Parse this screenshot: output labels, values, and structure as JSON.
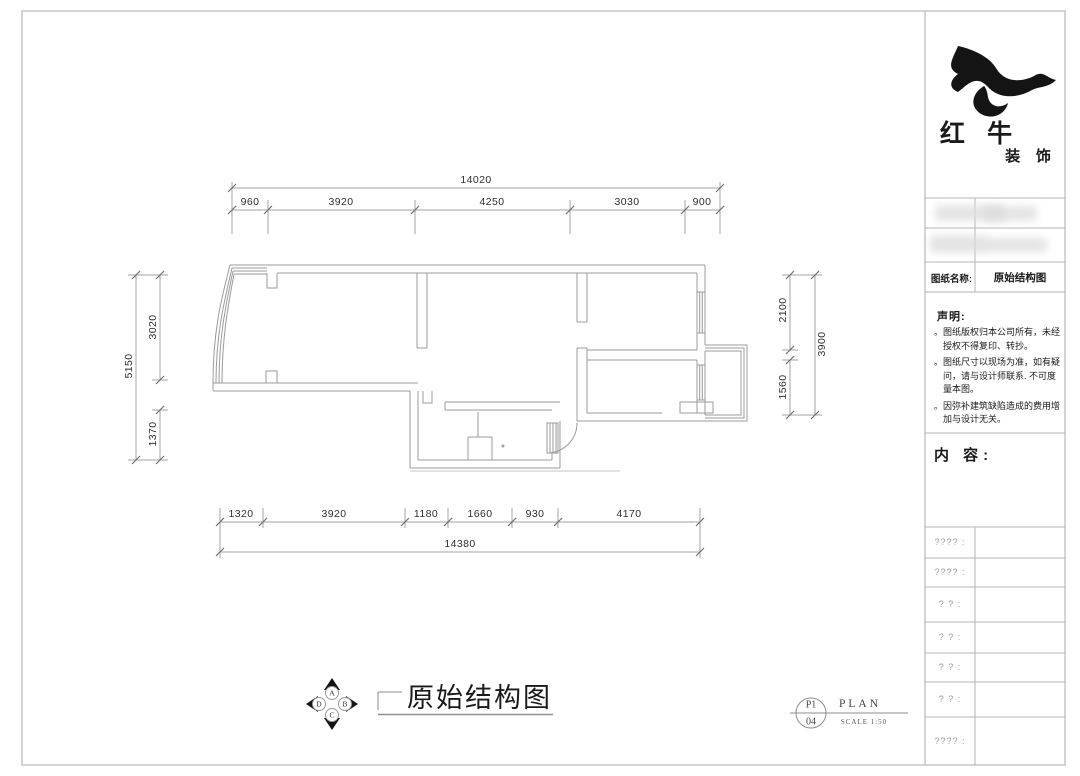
{
  "titleblock": {
    "brand_name": "红 牛",
    "brand_suffix": "装 饰",
    "drawing_name_label": "图纸名称:",
    "drawing_name_value": "原始结构图",
    "statement_title": "声明:",
    "bullet_char": "。",
    "statement_items": [
      "图纸版权归本公司所有，未经授权不得复印、转抄。",
      "图纸尺寸以现场为准，如有疑问，请与设计师联系. 不可度量本图。",
      "因弥补建筑缺陷造成的费用增加与设计无关。"
    ],
    "content_label": "内 容:",
    "info_rows": [
      "???? :",
      "???? :",
      "? ? :",
      "? ? :",
      "? ? :",
      "? ? :",
      "???? :"
    ]
  },
  "plan": {
    "dims_top": {
      "total": "14020",
      "segments": [
        "960",
        "3920",
        "4250",
        "3030",
        "900"
      ]
    },
    "dims_bottom": {
      "total": "14380",
      "segments": [
        "1320",
        "3920",
        "1180",
        "1660",
        "930",
        "4170"
      ]
    },
    "dims_left": {
      "total": "5150",
      "segments": [
        "3020",
        "1370"
      ]
    },
    "dims_right": {
      "total": "3900",
      "segments": [
        "2100",
        "1560"
      ]
    }
  },
  "footer": {
    "drawing_title": "原始结构图",
    "compass": {
      "top": "A",
      "right": "B",
      "bottom": "C",
      "left": "D"
    },
    "sheet_code_top": "P1",
    "sheet_code_bottom": "04",
    "plan_label": "PLAN",
    "scale_label": "SCALE 1:50"
  }
}
